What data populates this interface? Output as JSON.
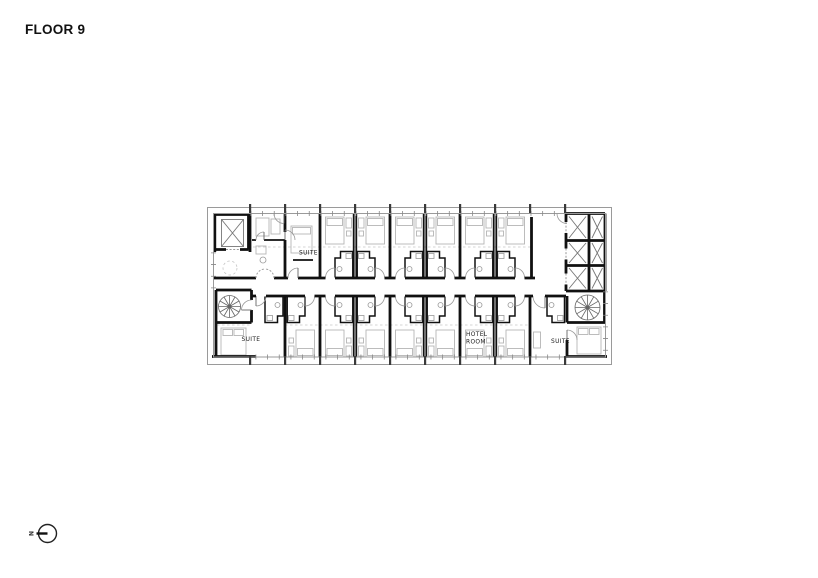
{
  "page": {
    "title": "FLOOR 9",
    "background": "#ffffff"
  },
  "plan": {
    "labels": {
      "suite_top_left": "SUITE",
      "suite_bottom_left": "SUITE",
      "hotel_room_line1": "HOTEL",
      "hotel_room_line2": "ROOM",
      "suite_bottom_right": "SUITE"
    },
    "colors": {
      "wall": "#111111",
      "furniture": "#b5b5b5",
      "fixture": "#999999",
      "boundary": "#9a9a9a",
      "dashed": "#c6c6c6",
      "text": "#1a1a1a"
    }
  },
  "compass": {
    "label": "N"
  }
}
